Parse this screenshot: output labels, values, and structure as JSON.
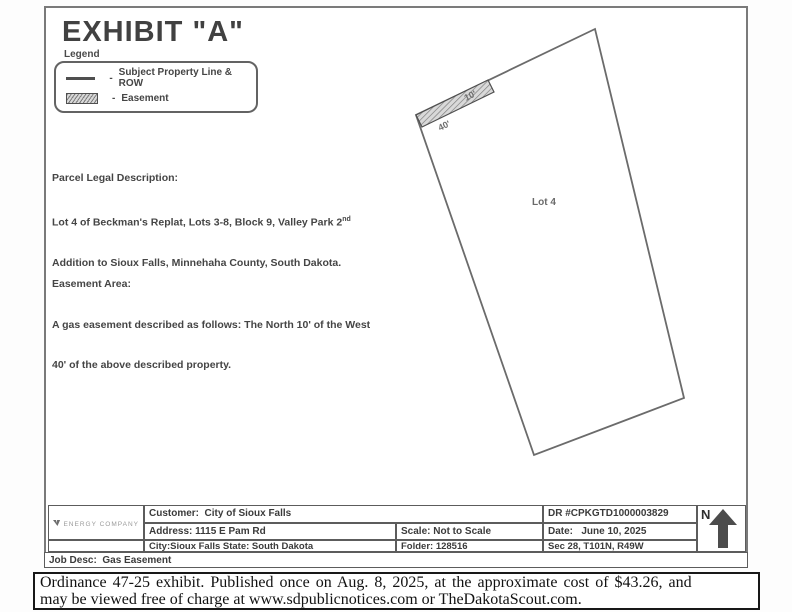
{
  "sheet": {
    "title": "EXHIBIT \"A\"",
    "legend": {
      "label": "Legend",
      "items": [
        {
          "dash": "-",
          "label": "Subject Property Line & ROW"
        },
        {
          "dash": "-",
          "label": "Easement"
        }
      ]
    },
    "parcel_legal": {
      "heading": "Parcel Legal Description:",
      "line1_main": "Lot 4 of Beckman's Replat, Lots 3-8, Block 9, Valley Park 2",
      "line1_sup": "nd",
      "line2": "Addition to Sioux Falls, Minnehaha County, South Dakota."
    },
    "easement_area": {
      "heading": "Easement Area:",
      "line1": "A gas easement described as follows: The North 10' of the West",
      "line2": "40' of the above described property."
    },
    "drawing": {
      "lot_label": "Lot 4",
      "dim_west": "40'",
      "dim_north": "10'"
    },
    "titleblock": {
      "logo_line1": "MIDAMERICAN",
      "logo_line2": "ENERGY COMPANY",
      "customer": "Customer:  City of Sioux Falls",
      "address": "Address: 1115 E Pam Rd",
      "city_state": "City:Sioux Falls State: South Dakota",
      "scale": "Scale: Not to Scale",
      "folder": "Folder: 128516",
      "dr_number": "DR #CPKGTD1000003829",
      "date": "Date:   June 10, 2025",
      "section": "Sec 28, T101N, R49W",
      "north_label": "N",
      "job_desc": "Job Desc:  Gas Easement"
    }
  },
  "caption": {
    "line1": "Ordinance 47-25 exhibit. Published once on Aug. 8, 2025, at the approximate cost of $43.26, and",
    "line2": "may be viewed free of charge at www.sdpublicnotices.com or TheDakotaScout.com."
  },
  "colors": {
    "ink": "#424242",
    "line": "#6b6b6b",
    "caption_ink": "#121212"
  }
}
